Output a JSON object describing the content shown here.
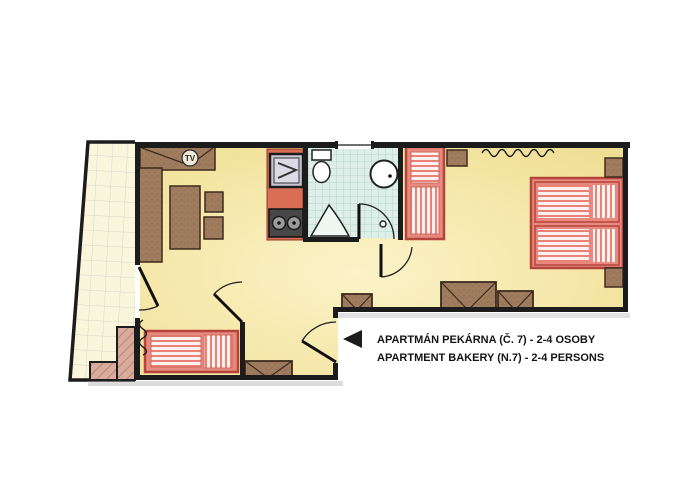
{
  "plan": {
    "caption": {
      "line1": "APARTMÁN PEKÁRNA (Č. 7) - 2-4 OSOBY",
      "line2": "APARTMENT BAKERY (N.7) - 2-4 PERSONS"
    },
    "tv_label": "TV",
    "colors": {
      "wall": "#1c1c1c",
      "room_fill": "#f2e29b",
      "room_fill_light": "#fbf3cc",
      "terrace_fill": "#faf6dc",
      "terrace_grid": "#d6d6cc",
      "furniture_brown": "#a07c5f",
      "furniture_border": "#3d2b1c",
      "bed_frame": "#e8897f",
      "bed_border": "#b5443c",
      "bed_stripe": "#ea8076",
      "kitchen_counter": "#d96e54",
      "bath_tile": "#ddefe8",
      "bath_grid": "#a8cfc6",
      "steps": "#d8ab9c"
    }
  }
}
